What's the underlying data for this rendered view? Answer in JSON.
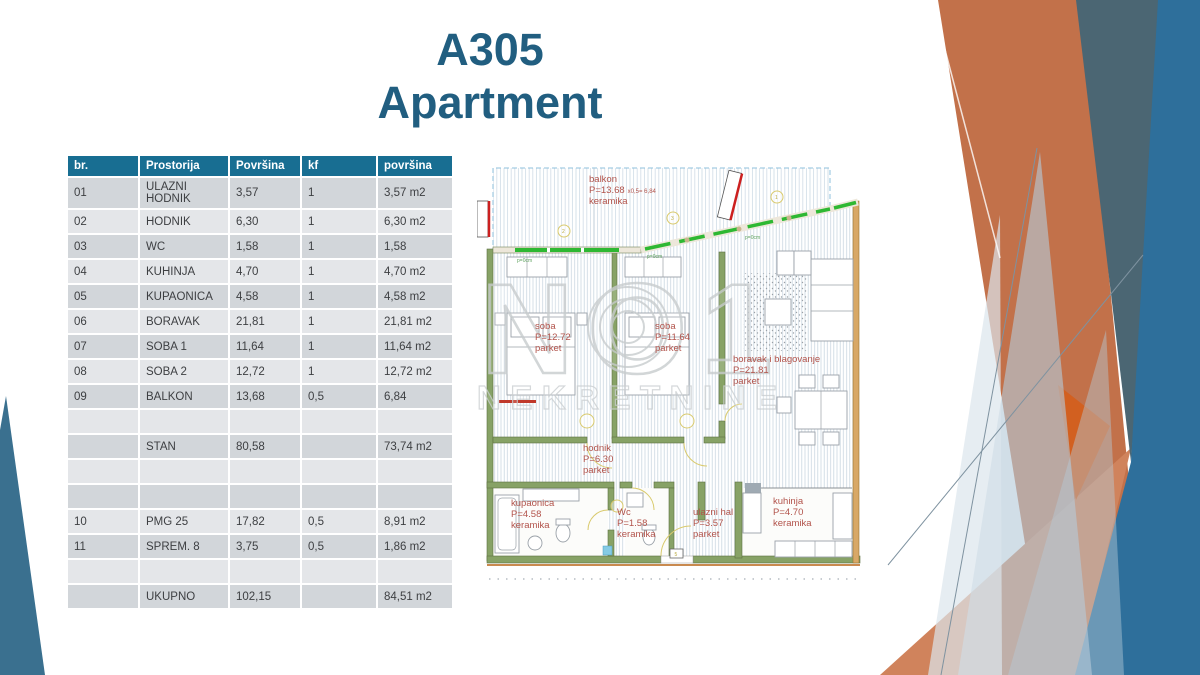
{
  "slide": {
    "title_line1": "A305",
    "title_line2": "Apartment"
  },
  "table": {
    "columns": [
      "br.",
      "Prostorija",
      "Površina",
      "kf",
      "površina"
    ],
    "rows": [
      {
        "cells": [
          "01",
          "ULAZNI HODNIK",
          "3,57",
          "1",
          "3,57 m2"
        ]
      },
      {
        "cells": [
          "02",
          "HODNIK",
          "6,30",
          "1",
          "6,30 m2"
        ]
      },
      {
        "cells": [
          "03",
          "WC",
          "1,58",
          "1",
          "1,58"
        ]
      },
      {
        "cells": [
          "04",
          "KUHINJA",
          "4,70",
          "1",
          "4,70 m2"
        ]
      },
      {
        "cells": [
          "05",
          "KUPAONICA",
          "4,58",
          "1",
          "4,58 m2"
        ]
      },
      {
        "cells": [
          "06",
          "BORAVAK",
          "21,81",
          "1",
          "21,81 m2"
        ]
      },
      {
        "cells": [
          "07",
          "SOBA 1",
          "11,64",
          "1",
          "11,64 m2"
        ]
      },
      {
        "cells": [
          "08",
          "SOBA 2",
          "12,72",
          "1",
          "12,72 m2"
        ]
      },
      {
        "cells": [
          "09",
          "BALKON",
          "13,68",
          "0,5",
          "6,84"
        ]
      },
      {
        "cells": [
          "",
          "",
          "",
          "",
          ""
        ]
      },
      {
        "cells": [
          "",
          "STAN",
          "80,58",
          "",
          "73,74 m2"
        ]
      },
      {
        "cells": [
          "",
          "",
          "",
          "",
          ""
        ]
      },
      {
        "cells": [
          "",
          "",
          "",
          "",
          ""
        ]
      },
      {
        "cells": [
          "10",
          "PMG 25",
          "17,82",
          "0,5",
          "8,91 m2"
        ]
      },
      {
        "cells": [
          "11",
          "SPREM. 8",
          "3,75",
          "0,5",
          "1,86 m2"
        ]
      },
      {
        "cells": [
          "",
          "",
          "",
          "",
          ""
        ]
      },
      {
        "cells": [
          "",
          "UKUPNO",
          "102,15",
          "",
          "84,51 m2"
        ]
      }
    ]
  },
  "floor_plan": {
    "watermark_big": "NO1",
    "watermark_sub": "NEKRETNINE",
    "entrance_marker": "5",
    "annotations": {
      "p0cm": "p=0cm",
      "marker1": "1",
      "marker2": "2",
      "marker3": "3"
    },
    "rooms": {
      "balkon": {
        "name": "balkon",
        "area": "P=13.68",
        "calc": "x0,5=  6,84",
        "floor": "keramika"
      },
      "soba1": {
        "name": "soba",
        "area": "P=12.72",
        "floor": "parket"
      },
      "soba2": {
        "name": "soba",
        "area": "P=11.64",
        "floor": "parket"
      },
      "boravak": {
        "name": "boravak i blagovanje",
        "area": "P=21.81",
        "floor": "parket"
      },
      "hodnik": {
        "name": "hodnik",
        "area": "P=6.30",
        "floor": "parket"
      },
      "kupaonica": {
        "name": "kupaonica",
        "area": "P=4.58",
        "floor": "keramika"
      },
      "wc": {
        "name": "Wc",
        "area": "P=1.58",
        "floor": "keramika"
      },
      "ulazni_hal": {
        "name": "ulazni hal",
        "area": "P=3.57",
        "floor": "parket"
      },
      "kuhinja": {
        "name": "kuhinja",
        "area": "P=4.70",
        "floor": "keramika"
      }
    }
  },
  "colors": {
    "table_header_teal": "#186E92",
    "title_blue": "#215E80",
    "row_dark": "#d2d6da",
    "row_light": "#e4e6e9",
    "label_red": "#B2534B",
    "glazing_green": "#2EB832",
    "decor_orange": "#C2714A",
    "decor_orange_bright": "#D35F1E",
    "decor_slate": "#4B6673",
    "decor_blue": "#2E6F9B",
    "decor_lightblue": "#B5CAD8",
    "left_wedge_teal": "#3A708F"
  }
}
